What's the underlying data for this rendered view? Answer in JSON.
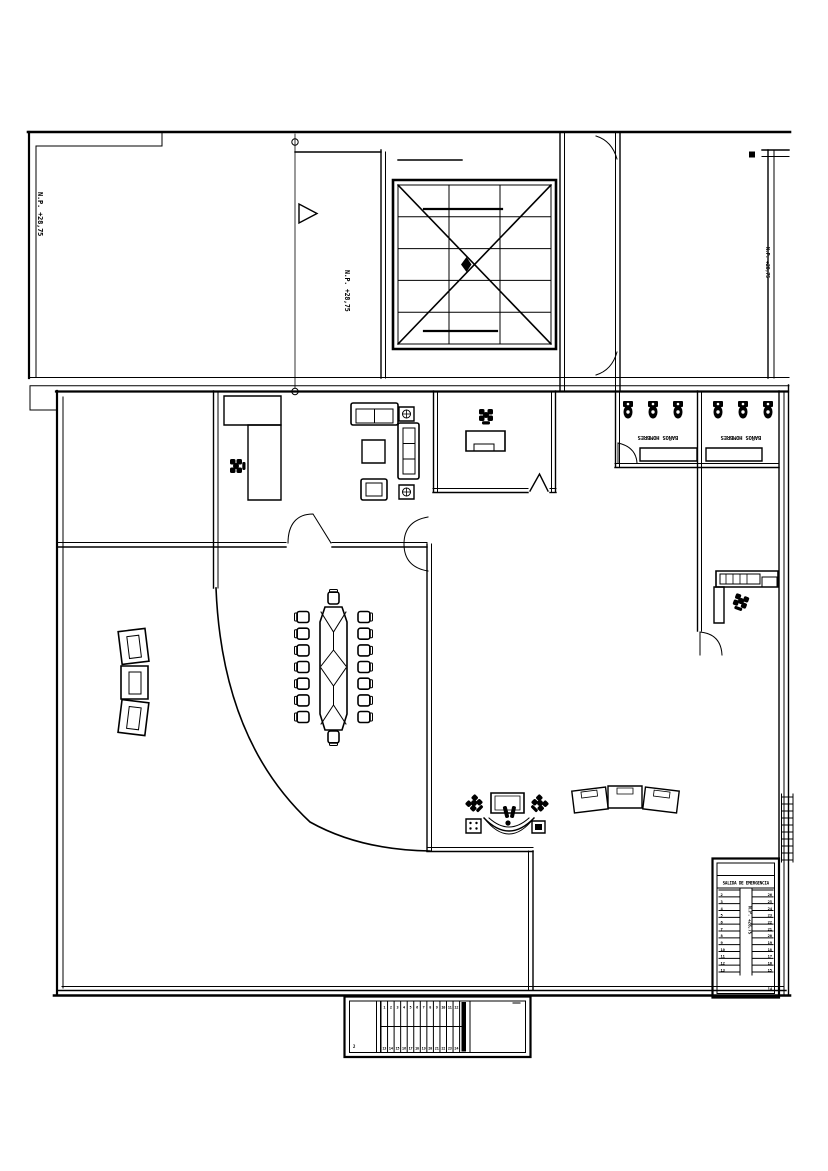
{
  "drawing": {
    "kind": "architectural-floor-plan",
    "background": "#ffffff",
    "line_color": "#000000"
  },
  "annotations": {
    "level_upper_left": "N.P. +28,75",
    "level_upper_mid": "N.P. +28,75",
    "level_right_wall": "N.P. +28,75"
  },
  "bathrooms": {
    "label_left": "BAÑOS HOMBRES",
    "label_right": "BAÑOS HOMBRES",
    "toilets_left": 3,
    "toilets_right": 3
  },
  "conference": {
    "chairs": 16
  },
  "emergency_stair": {
    "header": "SALIDA DE EMERGENCIA",
    "center_label": "N.P. +28,75",
    "left_steps": [
      2,
      3,
      4,
      5,
      6,
      7,
      8,
      9,
      10,
      11,
      12,
      13
    ],
    "right_steps": [
      26,
      25,
      24,
      23,
      22,
      21,
      20,
      19,
      18,
      17,
      16,
      15
    ],
    "bottom_step": "14"
  },
  "bottom_stair": {
    "top_numbers": [
      1,
      2,
      3,
      4,
      5,
      6,
      7,
      8,
      9,
      10,
      11,
      12
    ],
    "bottom_numbers": [
      13,
      14,
      15,
      16,
      17,
      18,
      19,
      20,
      21,
      22,
      23,
      24
    ],
    "left_mark": "2"
  }
}
